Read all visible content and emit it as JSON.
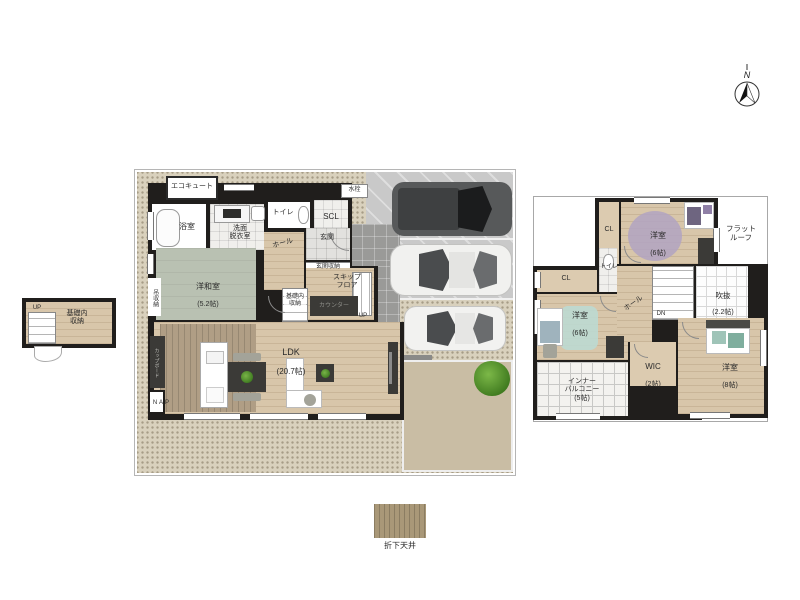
{
  "compass": {
    "n": "N"
  },
  "f1": {
    "ecocute": "エコキュート",
    "water_tap": "水栓",
    "bath": "浴室",
    "washroom": "洗面\n脱衣室",
    "toilet": "トイレ",
    "scl": "SCL",
    "hall": "ホール",
    "entrance": "玄関",
    "entrance_storage": "玄関収納",
    "washitsu": "洋和室",
    "washitsu_size": "(5.2帖)",
    "hanging_storage": "吊収納",
    "skip_floor": "スキップ\nフロア",
    "foundation_storage": "基礎内\n収納",
    "counter": "カウンター",
    "up": "UP",
    "ldk": "LDK",
    "ldk_size": "(20.7帖)",
    "cupboard": "カップボード",
    "pantry": "P\nA\nN"
  },
  "basement": {
    "label": "基礎内\n収納",
    "up": "UP"
  },
  "f2": {
    "cl_top": "CL",
    "bedroom_top": "洋室",
    "bedroom_top_size": "(6帖)",
    "flat_roof": "フラット\nルーフ",
    "toilet": "トイレ",
    "cl_left": "CL",
    "bedroom_left": "洋室",
    "bedroom_left_size": "(6帖)",
    "hall": "ホール",
    "dn": "DN",
    "void": "吹抜",
    "void_size": "(2.2帖)",
    "wic": "WIC",
    "wic_size": "(2帖)",
    "bedroom_right": "洋室",
    "bedroom_right_size": "(8帖)",
    "balcony": "インナー\nバルコニー\n(5帖)"
  },
  "legend": {
    "label": "折下天井"
  },
  "colors": {
    "wall": "#201e1c",
    "wood_floor": "#d8c6aa",
    "tatami": "#b9c1b2",
    "gravel": "#d9d1bd",
    "concrete": "#c9c9c9",
    "dirt": "#c9bda4",
    "drop_ceiling": "#b09e85",
    "rug_purple": "#b1a3c2",
    "rug_teal": "#bcd9d1"
  }
}
